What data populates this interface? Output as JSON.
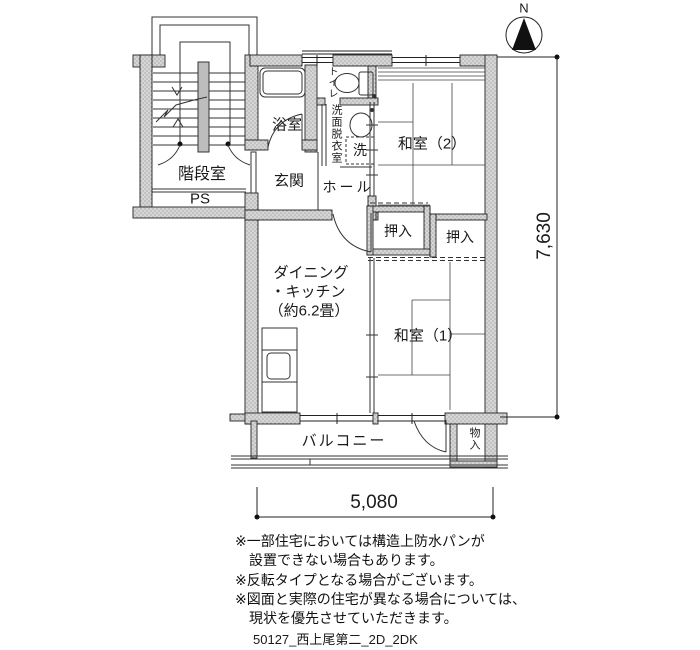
{
  "title": "apartment floor plan 2DK",
  "north_indicator": {
    "label": "N"
  },
  "rooms": {
    "stairwell": "階段室",
    "pipe_space": "PS",
    "bath": "浴室",
    "toilet": "トイレ",
    "washroom": "洗面脱衣室",
    "washer": "洗",
    "entrance": "玄関",
    "hall": "ホール",
    "japanese_room_2": "和室（2）",
    "closet_left": "押入",
    "closet_right": "押入",
    "dining_kitchen_line1": "ダイニング",
    "dining_kitchen_line2": "・キッチン",
    "dining_kitchen_line3": "（約6.2畳）",
    "japanese_room_1": "和室（1）",
    "balcony": "バルコニー",
    "storage": "物入"
  },
  "dimensions": {
    "vertical": "7,630",
    "horizontal": "5,080"
  },
  "notes": [
    "※一部住宅においては構造上防水パンが",
    "　設置できない場合もあります。",
    "※反転タイプとなる場合がございます。",
    "※図面と実際の住宅が異なる場合については、",
    "　現状を優先させていただきます。"
  ],
  "plan_code": "50127_西上尾第二_2D_2DK",
  "colors": {
    "wall_fill": "#d6d6d6",
    "wall_dot": "#8f8f8f",
    "line": "#222222",
    "tatami_line": "#444444"
  }
}
